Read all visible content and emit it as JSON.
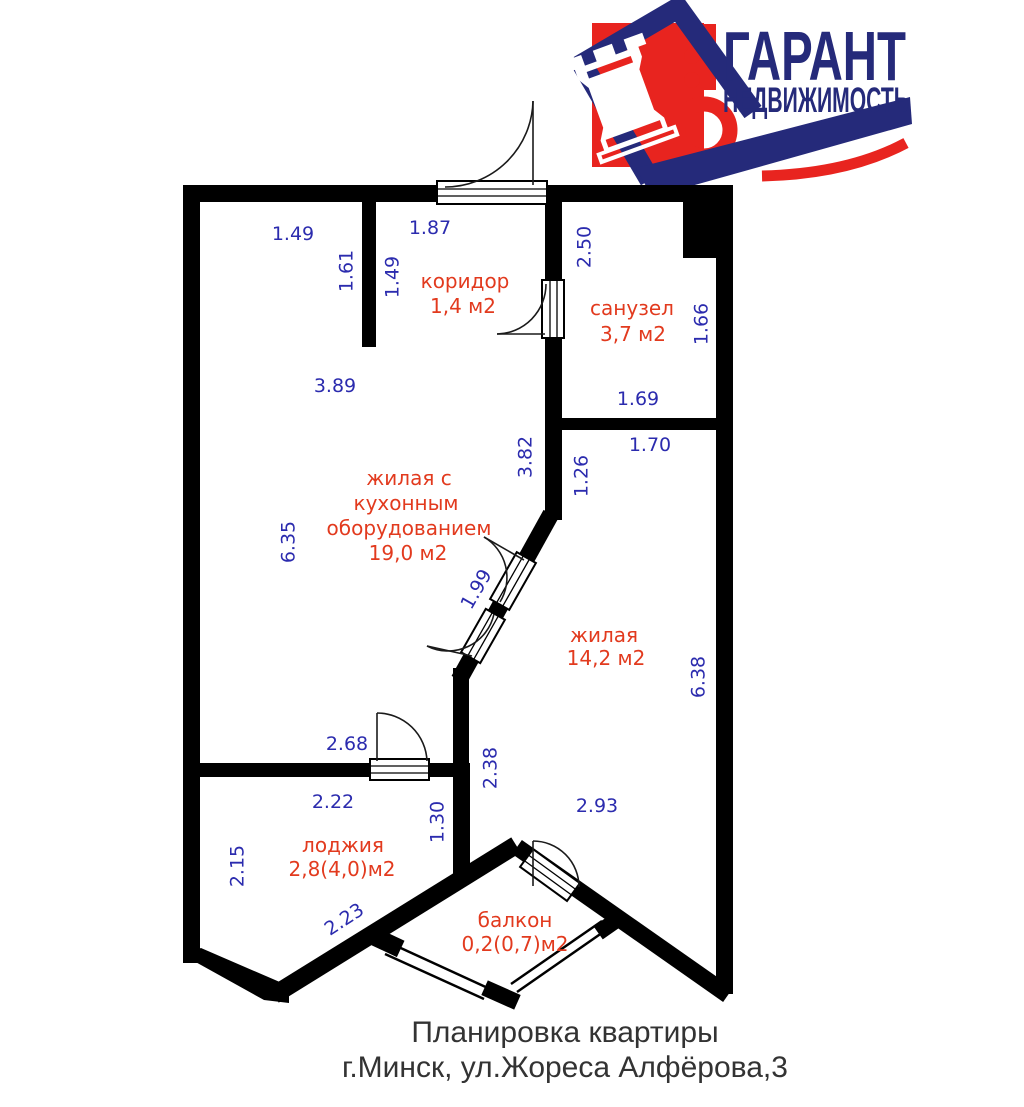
{
  "logo": {
    "title": "ГАРАНТ",
    "subtitle": "НЕДВИЖИМОСТЬ",
    "rook_icon": "♜",
    "navy": "#252a7a",
    "red": "#e8241f"
  },
  "plan": {
    "wall_color": "#000000",
    "dim_color": "#2b2bae",
    "room_color": "#e23a1e",
    "rooms": [
      {
        "id": "koridor",
        "name": "коридор",
        "area": "1,4 м2"
      },
      {
        "id": "sanuzel",
        "name": "санузел",
        "area": "3,7 м2"
      },
      {
        "id": "zhilaya-kuhnya",
        "lines": [
          "жилая с",
          "кухонным",
          "оборудованием"
        ],
        "area": "19,0 м2"
      },
      {
        "id": "zhilaya",
        "name": "жилая",
        "area": "14,2 м2"
      },
      {
        "id": "lodzhiya",
        "name": "лоджия",
        "area": "2,8(4,0)м2"
      },
      {
        "id": "balkon",
        "name": "балкон",
        "area": "0,2(0,7)м2"
      }
    ],
    "dimensions": [
      "1.49",
      "1.87",
      "1.61",
      "1.49",
      "2.50",
      "1.66",
      "3.89",
      "1.69",
      "1.70",
      "3.82",
      "1.26",
      "6.35",
      "1.99",
      "6.38",
      "2.68",
      "2.38",
      "2.22",
      "1.30",
      "2.93",
      "2.15",
      "2.23"
    ]
  },
  "caption": {
    "line1": "Планировка квартиры",
    "line2": "г.Минск, ул.Жореса Алфёрова,3"
  }
}
